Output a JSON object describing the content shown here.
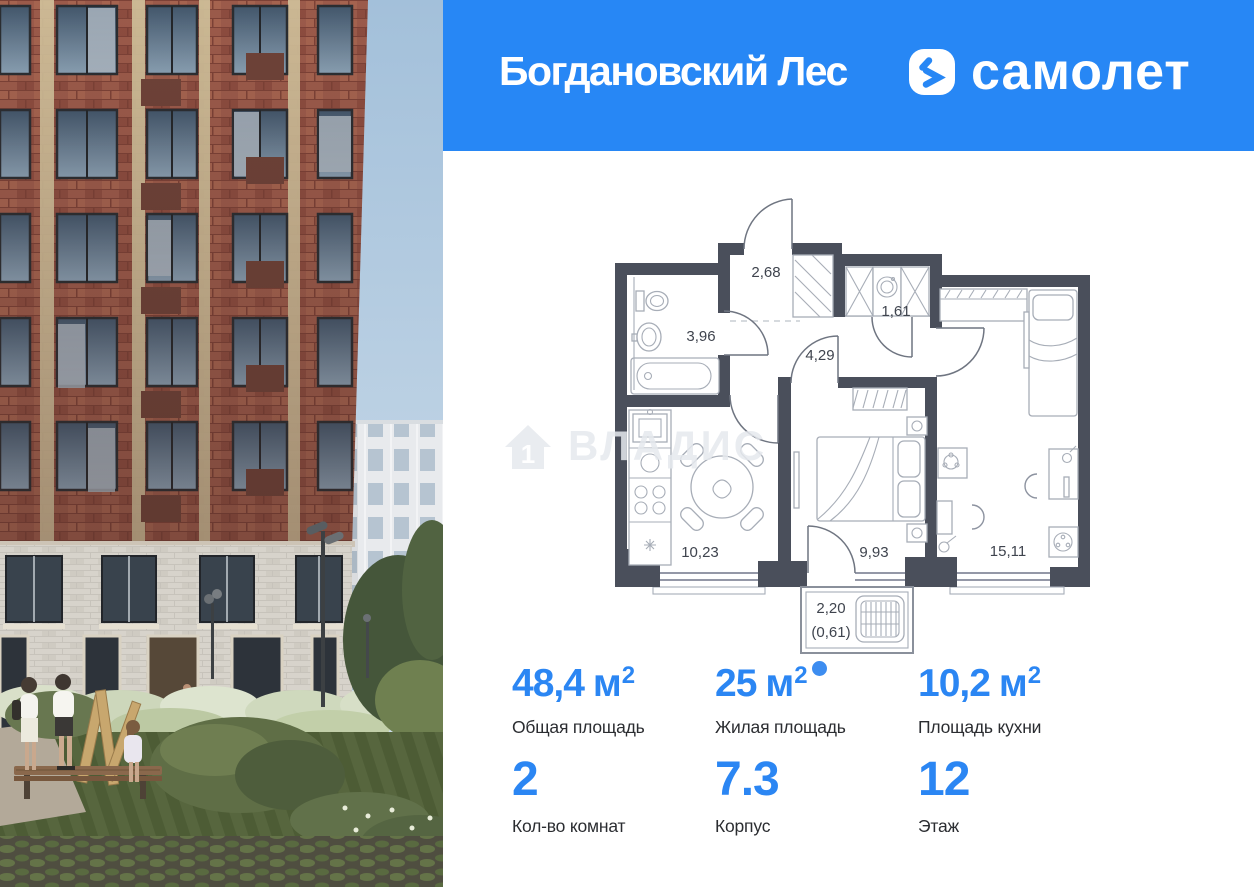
{
  "header": {
    "project_name": "Богдановский Лес",
    "brand_name": "самолет"
  },
  "colors": {
    "brand_blue": "#2787F5",
    "stat_number_blue": "#2B86F3",
    "plan_wall": "#4A4F5B"
  },
  "watermark": {
    "text": "ВЛАДИС",
    "house_number": "1"
  },
  "floor_plan": {
    "rooms": [
      {
        "id": "hallway",
        "area": "2,68"
      },
      {
        "id": "bathroom",
        "area": "3,96"
      },
      {
        "id": "corridor",
        "area": "4,29"
      },
      {
        "id": "wardrobe",
        "area": "1,61"
      },
      {
        "id": "kitchen",
        "area": "10,23"
      },
      {
        "id": "bedroom",
        "area": "9,93"
      },
      {
        "id": "living-room",
        "area": "15,11"
      },
      {
        "id": "balcony",
        "area": "2,20",
        "area_coefficient": "(0,61)"
      }
    ]
  },
  "stats": {
    "row1": [
      {
        "value": "48,4",
        "unit": "м",
        "unit_sup": "2",
        "label": "Общая площадь"
      },
      {
        "value": "25",
        "unit": "м",
        "unit_sup": "2",
        "label": "Жилая площадь"
      },
      {
        "value": "10,2",
        "unit": "м",
        "unit_sup": "2",
        "label": "Площадь кухни"
      }
    ],
    "row2": [
      {
        "value": "2",
        "label": "Кол-во комнат"
      },
      {
        "value": "7.3",
        "label": "Корпус"
      },
      {
        "value": "12",
        "label": "Этаж"
      }
    ]
  }
}
